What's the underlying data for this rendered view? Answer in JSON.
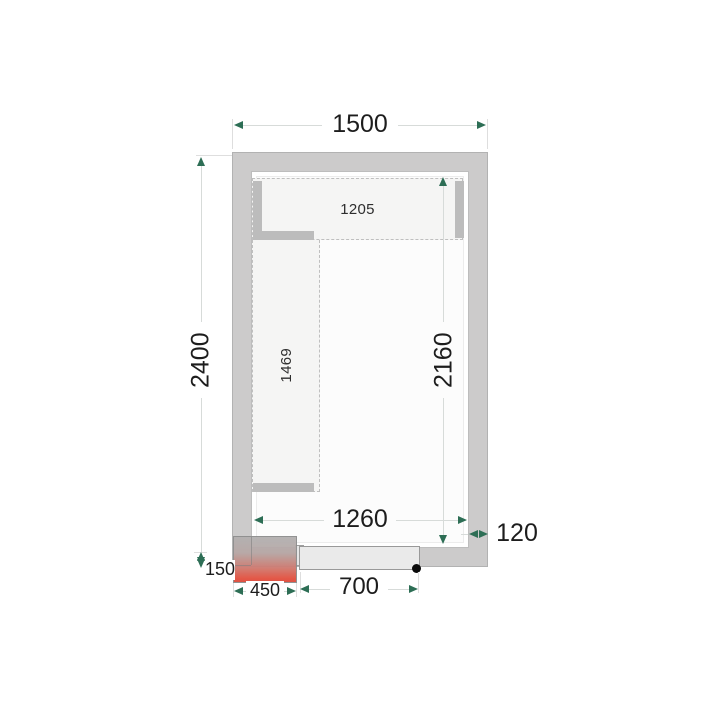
{
  "title": "Cold room floor plan drawing",
  "labels": {
    "outer_width": "1500",
    "outer_height": "2400",
    "inner_clear_height": "2160",
    "inner_clear_width": "1260",
    "wall_thickness": "120",
    "unit_protrusion": "150",
    "unit_width": "450",
    "door_width": "700",
    "shelf_top_length": "1205",
    "shelf_left_length": "1469"
  },
  "colors": {
    "wall": "#cccbcb",
    "shelf_fill": "#f5f5f4",
    "shelf_board": "#bcbcbc",
    "dimension_arrow": "#2d6e55",
    "dimension_line": "#d7dbd9",
    "unit_gradient_top": "#b2b0b0",
    "unit_gradient_bottom": "#de4a3c",
    "door_leaf": "#eaeaea",
    "text": "#1d1d1d"
  }
}
